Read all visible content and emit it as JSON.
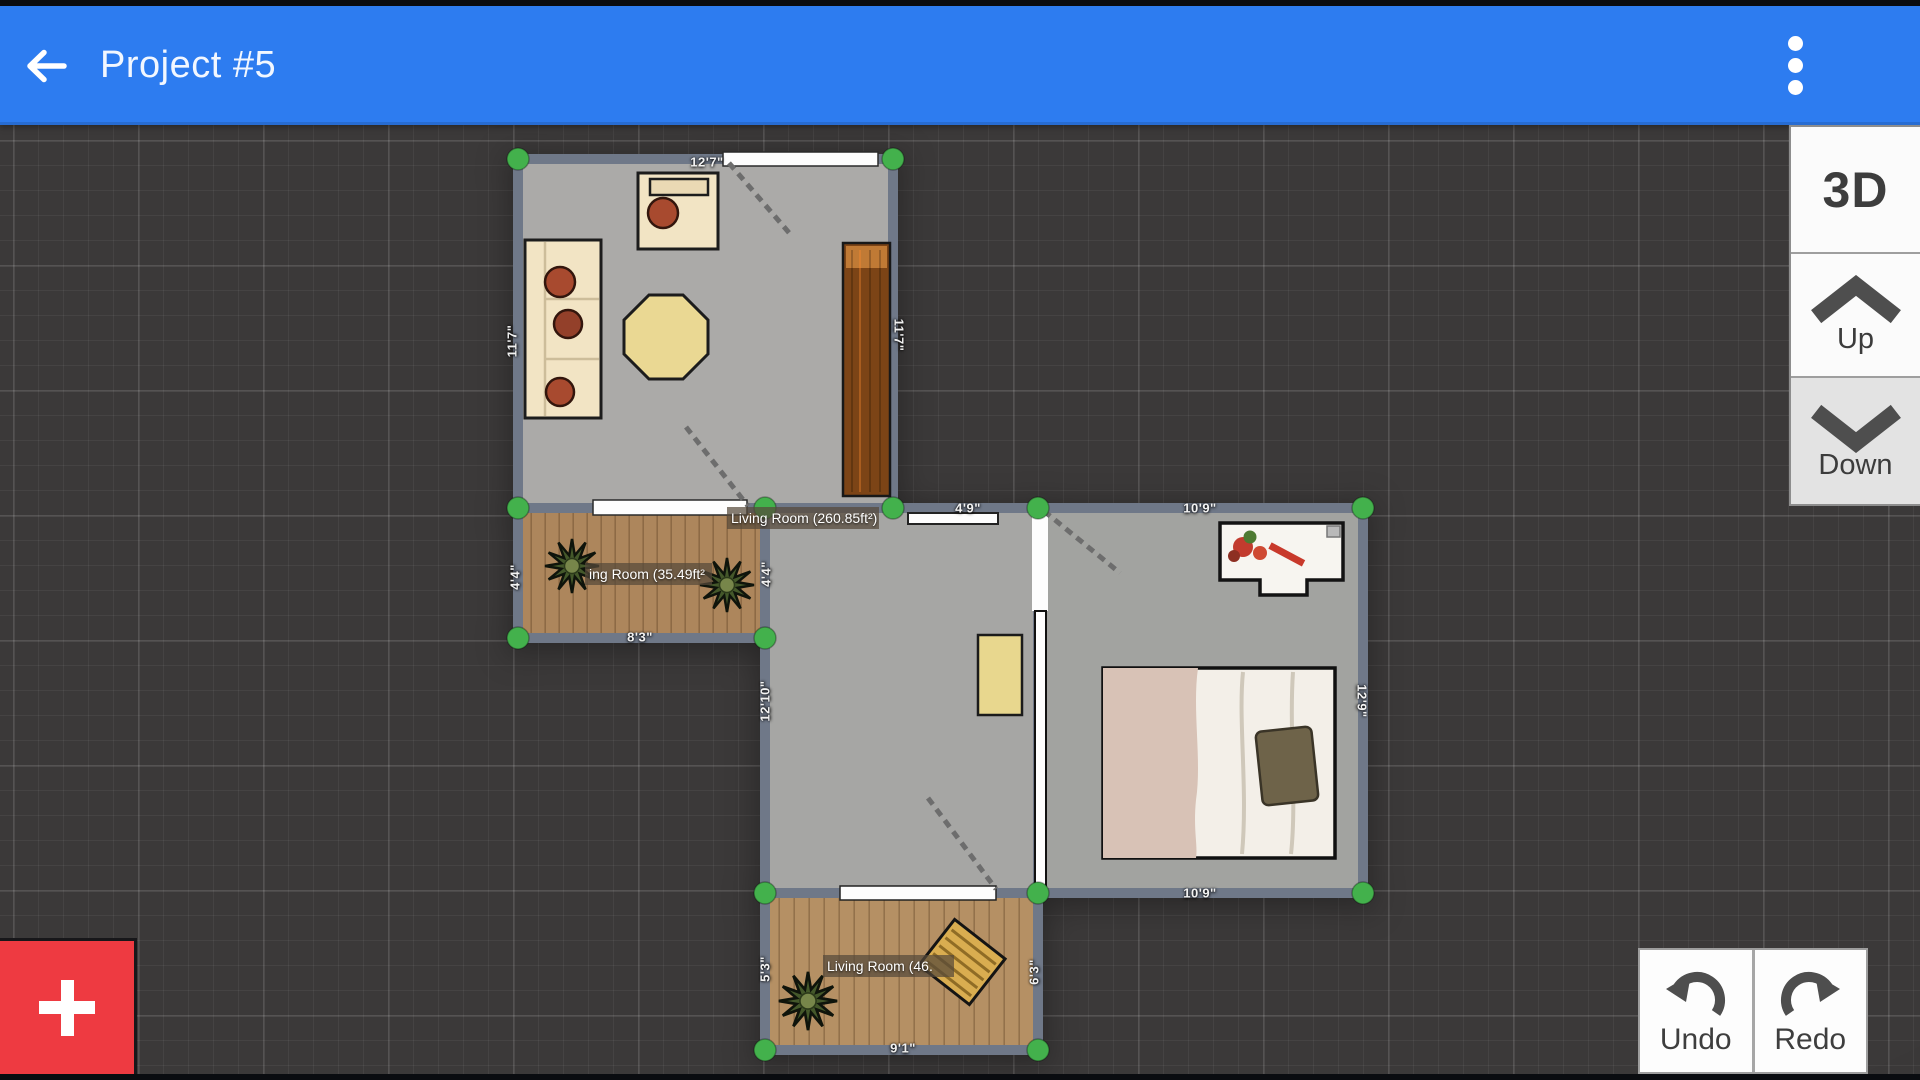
{
  "header": {
    "title": "Project #5"
  },
  "icons": {
    "back": "arrow-left",
    "menu": "kebab-vertical",
    "fab": "plus",
    "up": "chevron-up",
    "down": "chevron-down",
    "undo": "arrow-undo",
    "redo": "arrow-redo"
  },
  "view_controls": {
    "three_d_label": "3D",
    "up_label": "Up",
    "down_label": "Down"
  },
  "history": {
    "undo_label": "Undo",
    "redo_label": "Redo"
  },
  "rooms": {
    "living_main": {
      "name": "Living Room (260.85ft²)",
      "dim_top": "12'7\"",
      "dim_left": "11'7\"",
      "dim_right": "11'7\""
    },
    "living_small": {
      "name_clipped": "ing Room (35.49ft²",
      "dim_left": "4'4\"",
      "dim_right": "4'4\"",
      "dim_bottom": "8'3\""
    },
    "hall": {
      "dim_top": "4'9\"",
      "dim_left": "12'10\""
    },
    "bedroom": {
      "dim_top": "10'9\"",
      "dim_bottom": "10'9\"",
      "dim_right": "12'9\""
    },
    "living_bottom": {
      "name_clipped": "Living Room (46.",
      "dim_left": "5'3\"",
      "dim_right": "6'3\"",
      "dim_bottom": "9'1\""
    }
  },
  "colors": {
    "header_blue": "#2d7cf0",
    "fab_red": "#ee3a41",
    "handle_green": "#43b14c",
    "canvas_bg": "#3b3939",
    "wall": "#6f7888"
  }
}
